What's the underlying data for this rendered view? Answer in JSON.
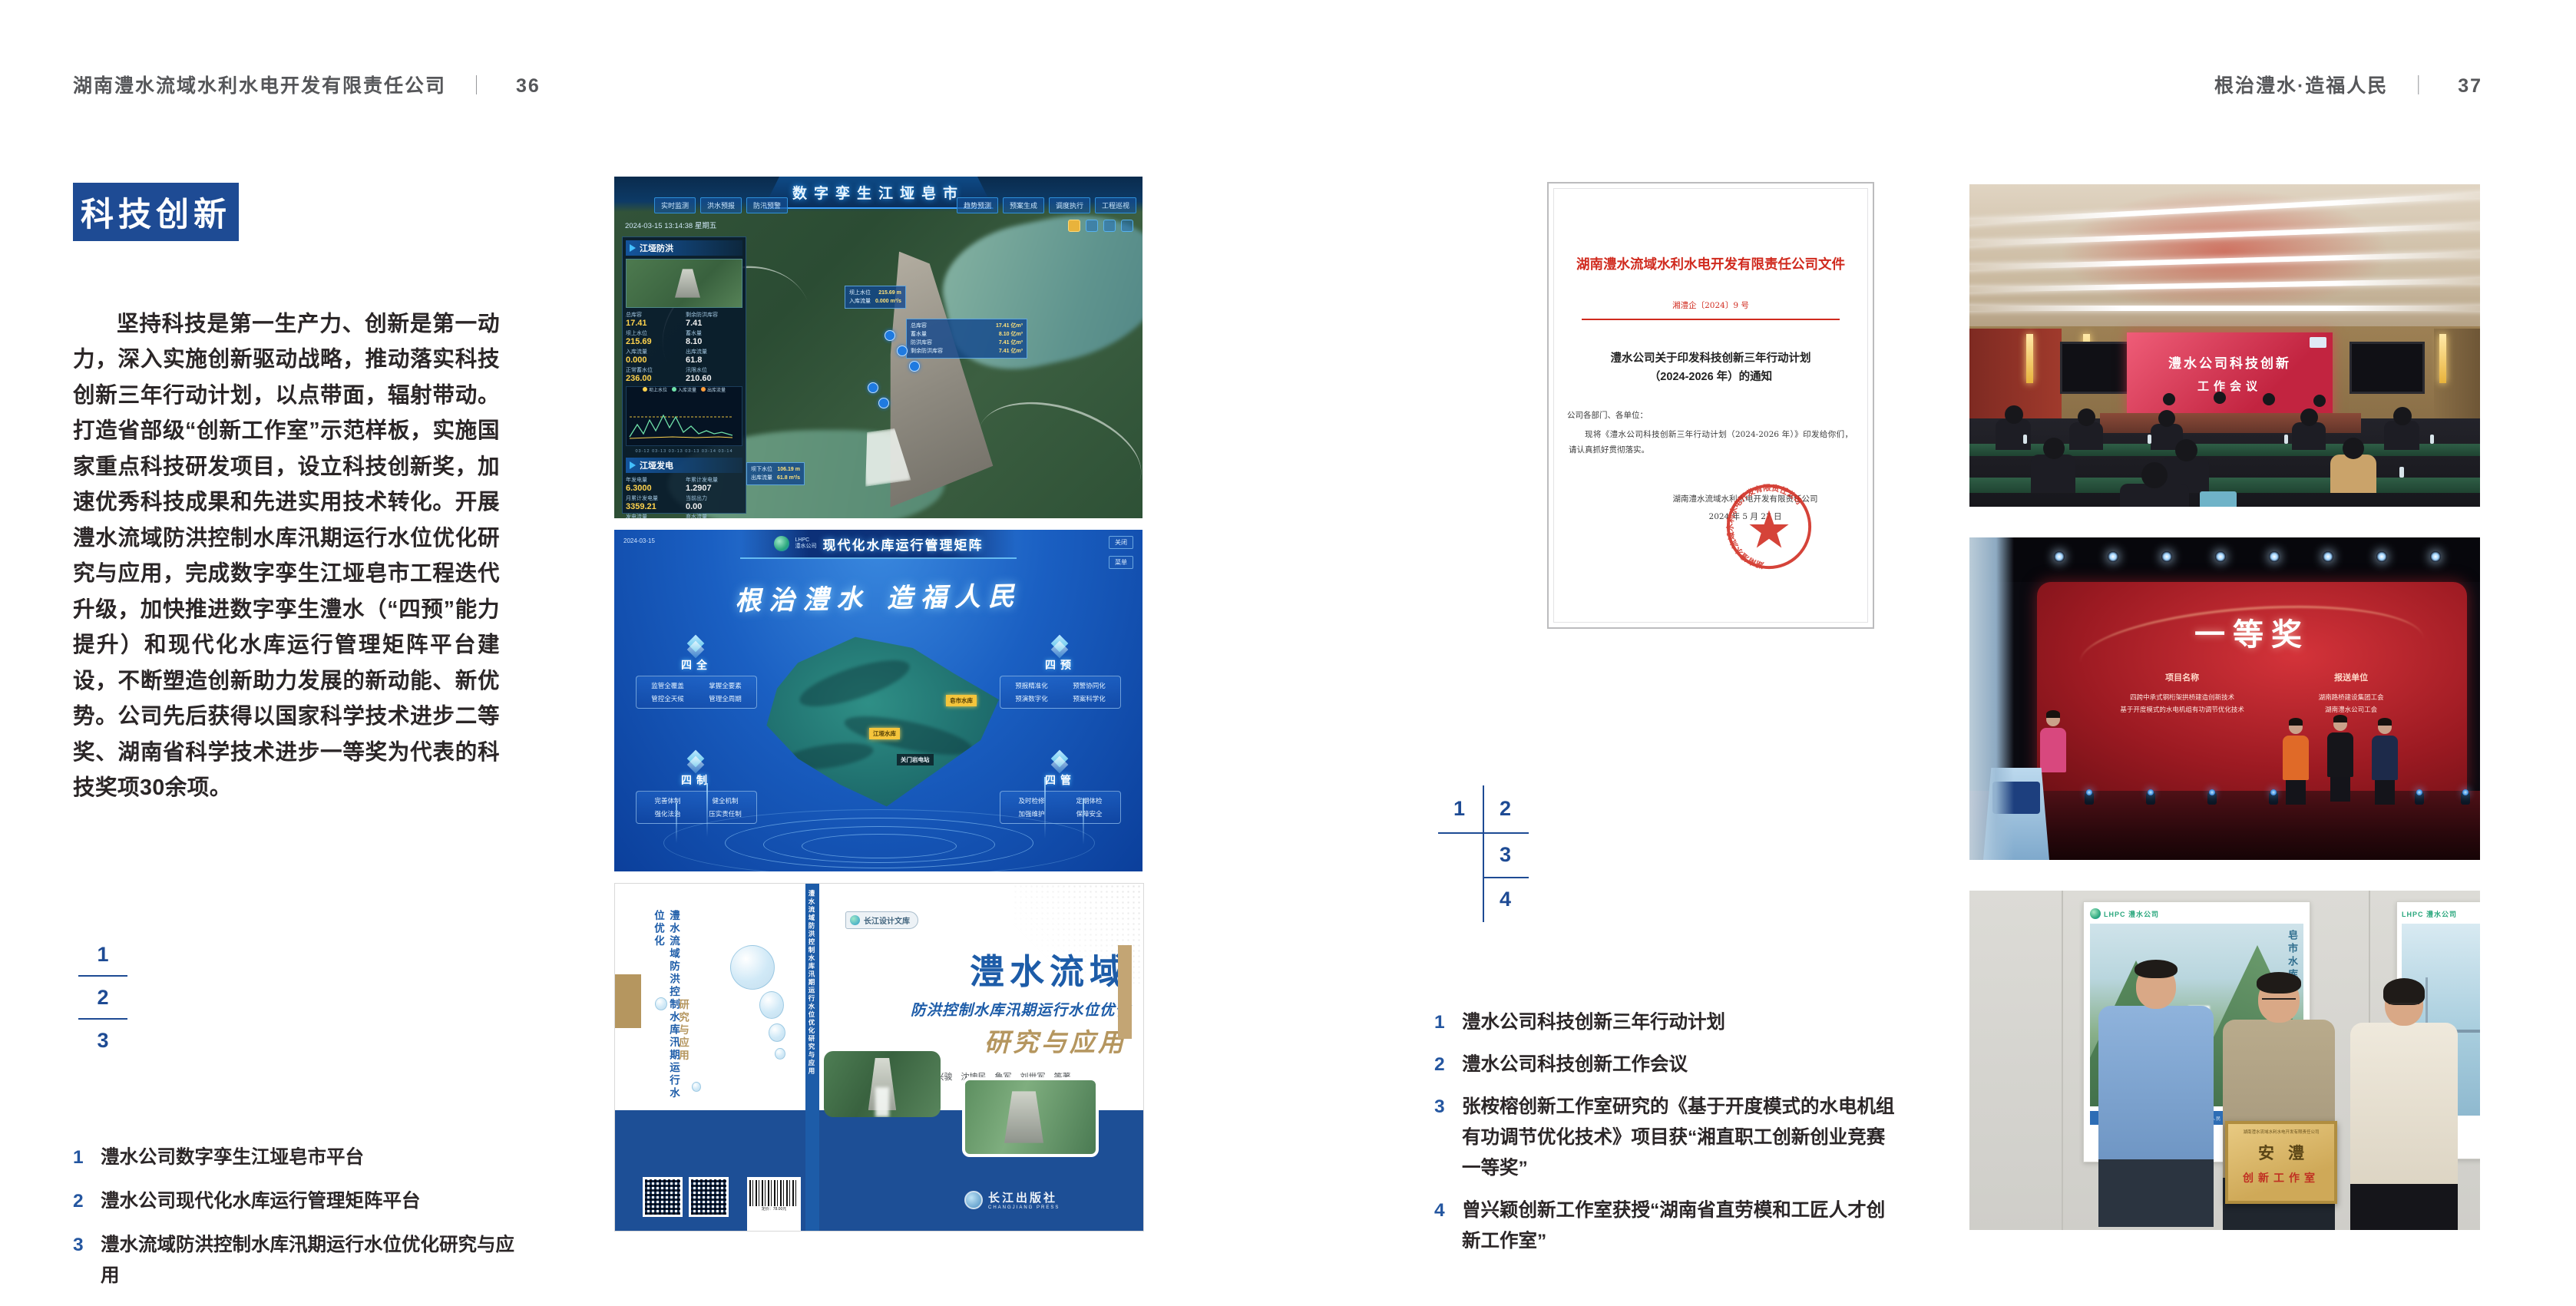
{
  "colors": {
    "accent_blue": "#1e4b94",
    "doc_red": "#d02a1e",
    "book_blue": "#1d5ca8",
    "tan": "#b5965f"
  },
  "page_left": {
    "header_title": "湖南澧水流域水利水电开发有限责任公司",
    "header_sep": "｜",
    "header_page": "36",
    "badge": "科技创新",
    "body": "坚持科技是第一生产力、创新是第一动力，深入实施创新驱动战略，推动落实科技创新三年行动计划，以点带面，辐射带动。打造省部级“创新工作室”示范样板，实施国家重点科技研发项目，设立科技创新奖，加速优秀科技成果和先进实用技术转化。开展澧水流域防洪控制水库汛期运行水位优化研究与应用，完成数字孪生江垭皂市工程迭代升级，加快推进数字孪生澧水（“四预”能力提升）和现代化水库运行管理矩阵平台建设，不断塑造创新助力发展的新动能、新优势。公司先后获得以国家科学技术进步二等奖、湖南省科学技术进步一等奖为代表的科技奖项30余项。",
    "index": [
      "1",
      "2",
      "3"
    ],
    "captions": [
      {
        "num": "1",
        "text": "澧水公司数字孪生江垭皂市平台"
      },
      {
        "num": "2",
        "text": "澧水公司现代化水库运行管理矩阵平台"
      },
      {
        "num": "3",
        "text": "澧水流域防洪控制水库汛期运行水位优化研究与应用"
      }
    ]
  },
  "page_right": {
    "header_title": "根治澧水·造福人民",
    "header_sep": "｜",
    "header_page": "37",
    "index": [
      "1",
      "2",
      "3",
      "4"
    ],
    "captions": [
      {
        "num": "1",
        "text": "澧水公司科技创新三年行动计划"
      },
      {
        "num": "2",
        "text": "澧水公司科技创新工作会议"
      },
      {
        "num": "3",
        "text": "张桉榕创新工作室研究的《基于开度模式的水电机组有功调节优化技术》项目获“湘直职工创新创业竞赛一等奖”"
      },
      {
        "num": "4",
        "text": "曾兴颖创新工作室获授“湖南省直劳模和工匠人才创新工作室”"
      }
    ]
  },
  "fig_dashboard": {
    "title": "数字孪生江垭皂市",
    "timestamp": "2024-03-15 13:14:38 星期五",
    "tabs_left": [
      "实时监测",
      "洪水预报",
      "防汛预警"
    ],
    "tabs_right": [
      "趋势预测",
      "预案生成",
      "调度执行",
      "工程巡视"
    ],
    "panel1_title": "江垭防洪",
    "stats1": [
      {
        "label": "总库容",
        "value": "17.41"
      },
      {
        "label": "剩余防洪库容",
        "value": "7.41"
      },
      {
        "label": "坝上水位",
        "value": "215.69"
      },
      {
        "label": "蓄水量",
        "value": "8.10"
      },
      {
        "label": "入库流量",
        "value": "0.000"
      },
      {
        "label": "出库流量",
        "value": "61.8"
      },
      {
        "label": "正常蓄水位",
        "value": "236.00"
      },
      {
        "label": "汛限水位",
        "value": "210.60"
      }
    ],
    "legend": [
      "坝上水位",
      "入库流量",
      "出库流量"
    ],
    "chart_dates": "03-12  03-13  03-13  03-13  03-14  03-14",
    "panel2_title": "江垭发电",
    "stats2": [
      {
        "label": "年发电量",
        "value": "6.3000"
      },
      {
        "label": "年累计发电量",
        "value": "1.2907"
      },
      {
        "label": "月累计发电量",
        "value": "3359.21"
      },
      {
        "label": "当前出力",
        "value": "0.00"
      },
      {
        "label": "发电流量",
        "value": "0.00"
      },
      {
        "label": "弃水流量",
        "value": "0.00"
      }
    ],
    "gauges": [
      "0.00",
      "102.98",
      "0.00"
    ],
    "tooltip1": [
      {
        "label": "坝上水位",
        "value": "215.69 m"
      },
      {
        "label": "入库流量",
        "value": "0.000 m³/s"
      }
    ],
    "tooltip2": [
      {
        "label": "总库容",
        "value": "17.41 亿m³"
      },
      {
        "label": "蓄水量",
        "value": "8.10 亿m³"
      },
      {
        "label": "防洪库容",
        "value": "7.41 亿m³"
      },
      {
        "label": "剩余防洪库容",
        "value": "7.41 亿m³"
      }
    ],
    "tooltip3": [
      {
        "label": "坝下水位",
        "value": "106.19 m"
      },
      {
        "label": "出库流量",
        "value": "61.8 m³/s"
      }
    ]
  },
  "fig_matrix": {
    "logo_line1": "LHPC",
    "logo_line2": "澧水公司",
    "title": "现代化水库运行管理矩阵",
    "date": "2024-03-15",
    "btn1": "关闭",
    "btn2": "菜单",
    "slogan": "根治澧水  造福人民",
    "groups": [
      {
        "name": "四全",
        "items": [
          "监管全覆盖",
          "掌握全要素",
          "管控全天候",
          "管理全周期"
        ]
      },
      {
        "name": "四预",
        "items": [
          "预报精准化",
          "预警协同化",
          "预演数字化",
          "预案科学化"
        ]
      },
      {
        "name": "四制",
        "items": [
          "完善体制",
          "健全机制",
          "强化法治",
          "压实责任制"
        ]
      },
      {
        "name": "四管",
        "items": [
          "及时检修",
          "定期体检",
          "加强维护",
          "保障安全"
        ]
      }
    ],
    "markers": [
      {
        "text": "皂市水库"
      },
      {
        "text": "江垭水库"
      },
      {
        "text": "关门岩电站"
      }
    ]
  },
  "fig_book": {
    "imprint": "长江设计文库",
    "title_main": "澧水流域",
    "title_sub": "防洪控制水库汛期运行水位优化",
    "title_tail": "研究与应用",
    "authors": "洪兴骏　沈坤民　鲁军　刘世军　等著",
    "publisher": "长江出版社",
    "publisher_en": "CHANGJIANG PRESS",
    "spine_text": "澧水流域防洪控制水库汛期运行水位优化研究与应用",
    "back_title": "澧水流域防洪控制水库汛期运行水位优化",
    "back_tail": "研究与应用",
    "barcode_caption": "定价：78.00元"
  },
  "doc": {
    "header": "湖南澧水流域水利水电开发有限责任公司文件",
    "doc_no": "湘澧企〔2024〕9 号",
    "title_line1": "澧水公司关于印发科技创新三年行动计划",
    "title_line2": "（2024-2026 年）的通知",
    "salutation": "公司各部门、各单位：",
    "body": "现将《澧水公司科技创新三年行动计划（2024-2026 年）》印发给你们，请认真抓好贯彻落实。",
    "signer": "湖南澧水流域水利水电开发有限责任公司",
    "date": "2024 年 5 月 27 日",
    "seal_text": "湖南澧水流域水利水电开发有限责任公司"
  },
  "photo_meeting": {
    "screen_line1": "澧水公司科技创新",
    "screen_line2": "工作会议"
  },
  "photo_award": {
    "screen_title": "一等奖",
    "col1_header": "项目名称",
    "col1_item1": "四跨中承式钢桁架拱桥建造创新技术",
    "col1_item2": "基于开度模式的水电机组有功调节优化技术",
    "col2_header": "报送单位",
    "col2_item1": "湖南路桥建设集团工会",
    "col2_item2": "湖南澧水公司工会"
  },
  "photo_plaque": {
    "plaque_top": "湖南澧水流域水利水电开发有限责任公司",
    "plaque_main": "安澧",
    "plaque_sub": "创新工作室",
    "poster_logo": "LHPC 澧水公司",
    "poster_vtext": "皂市水库",
    "poster_strip": "根治澧水 · 造福人民"
  }
}
